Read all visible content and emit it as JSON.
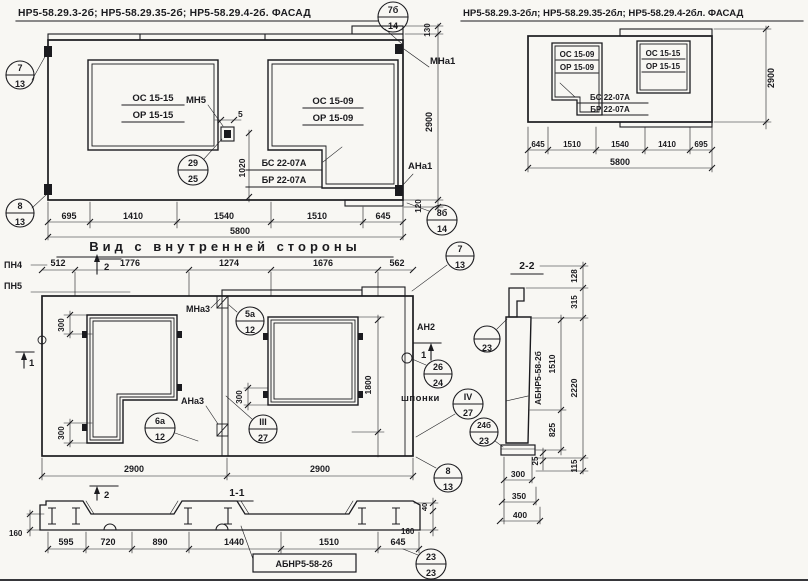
{
  "page": {
    "background": "#f8f7f3",
    "ink": "#1b1b1f"
  },
  "facade_left": {
    "title": "НР5-58.29.3-2б; НР5-58.29.35-2б; НР5-58.29.4-2б. ФАСАД",
    "window_left": {
      "top": "ОС 15-15",
      "bottom": "ОР 15-15"
    },
    "window_right": {
      "top": "ОС 15-09",
      "bottom": "ОР 15-09"
    },
    "lintel": {
      "top": "БС 22-07А",
      "bottom": "БР 22-07А"
    },
    "labels": {
      "mn5": "МН5",
      "mna1": "МНа1",
      "ana1": "АНа1"
    },
    "dims": {
      "d5": "5",
      "d1020": "1020",
      "d130": "130",
      "d120": "120",
      "d2900": "2900",
      "total": "5800",
      "bottom": [
        "695",
        "1410",
        "1540",
        "1510",
        "645"
      ]
    },
    "balloons": {
      "top_right": {
        "top": "7б",
        "bottom": "14"
      },
      "left_top": {
        "top": "7",
        "bottom": "13"
      },
      "left_bottom": {
        "top": "8",
        "bottom": "13"
      },
      "anchor": {
        "top": "29",
        "bottom": "25"
      },
      "bottom_right": {
        "top": "8б",
        "bottom": "14"
      }
    }
  },
  "facade_right": {
    "title": "НР5-58.29.3-2бл; НР5-58.29.35-2бл; НР5-58.29.4-2бл. ФАСАД",
    "window_left": {
      "top": "ОС 15-09",
      "bottom": "ОР 15-09"
    },
    "window_right": {
      "top": "ОС 15-15",
      "bottom": "ОР 15-15"
    },
    "lintel": {
      "top": "БС 22-07А",
      "bottom": "БР 22-07А"
    },
    "dims": {
      "d2900": "2900",
      "total": "5800",
      "bottom": [
        "645",
        "1510",
        "1540",
        "1410",
        "695"
      ]
    }
  },
  "inner_view": {
    "title": "Вид с внутренней стороны",
    "labels": {
      "pn4": "ПН4",
      "pn5": "ПН5",
      "mna3": "МНа3",
      "ana3": "АНа3",
      "an2": "АН2",
      "shponki": "шпонки"
    },
    "markers": {
      "section1": "1",
      "section2": "2"
    },
    "dims": {
      "top": [
        "512",
        "1776",
        "1274",
        "1676",
        "562"
      ],
      "d300": "300",
      "d1800": "1800",
      "bottom": [
        "2900",
        "2900"
      ]
    },
    "balloons": {
      "top_right": {
        "top": "7",
        "bottom": "13"
      },
      "joint_top": {
        "top": "5а",
        "bottom": "12"
      },
      "joint_bottom": {
        "top": "6а",
        "bottom": "12"
      },
      "frame": {
        "top": "III",
        "bottom": "27"
      },
      "anchor": {
        "top": "26",
        "bottom": "24"
      },
      "keys": {
        "top": "IV",
        "bottom": "27"
      },
      "bottom_right": {
        "top": "8",
        "bottom": "13"
      }
    }
  },
  "section_2_2": {
    "title": "2-2",
    "panel_mark": "АБНР5-58-2б",
    "dims": {
      "d128": "128",
      "d315": "315",
      "d1510": "1510",
      "d2220": "2220",
      "d825": "825",
      "d25": "25",
      "d115": "115",
      "d300": "300",
      "d350": "350",
      "d400": "400"
    },
    "balloons": {
      "top": {
        "top": "",
        "bottom": "23"
      },
      "bottom": {
        "top": "24б",
        "bottom": "23"
      }
    }
  },
  "section_1_1": {
    "title": "1-1",
    "panel_mark": "АБНР5-58-2б",
    "dims": {
      "bottom": [
        "595",
        "720",
        "890",
        "1440",
        "1510",
        "645"
      ],
      "d160_left": "160",
      "d160_right": "160",
      "d40": "40"
    },
    "balloons": {
      "plate": {
        "top": "23",
        "bottom": "23"
      },
      "corner": {
        "top": "8",
        "bottom": "13"
      }
    }
  }
}
